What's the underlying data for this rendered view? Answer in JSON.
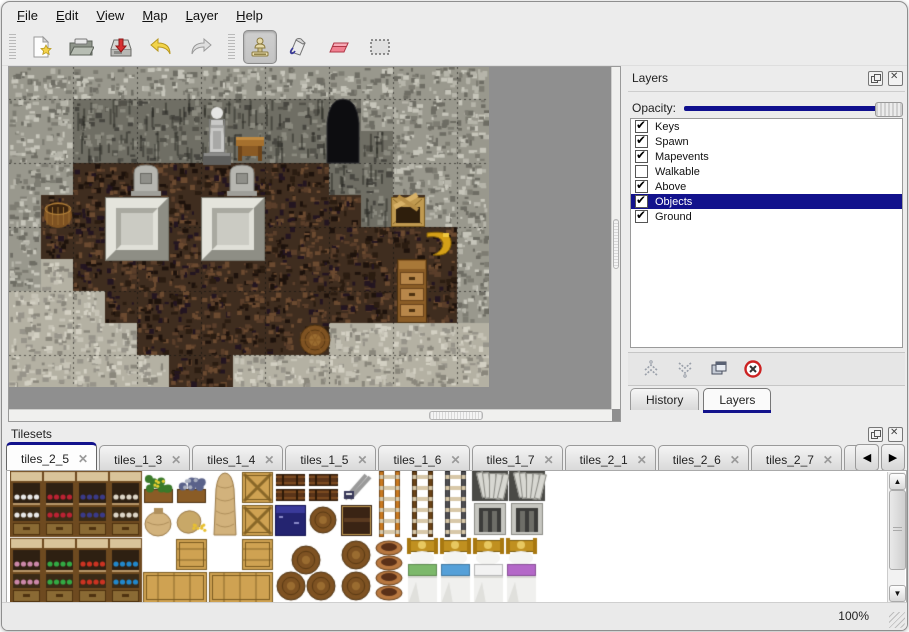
{
  "menu": {
    "items": [
      {
        "label": "File"
      },
      {
        "label": "Edit"
      },
      {
        "label": "View"
      },
      {
        "label": "Map"
      },
      {
        "label": "Layer"
      },
      {
        "label": "Help"
      }
    ]
  },
  "toolbar": {
    "tools": [
      {
        "name": "new",
        "icon": "new-file-icon",
        "selected": false
      },
      {
        "name": "open",
        "icon": "open-folder-icon",
        "selected": false
      },
      {
        "name": "save",
        "icon": "save-icon",
        "selected": false
      },
      {
        "name": "undo",
        "icon": "undo-arrow-icon",
        "selected": false
      },
      {
        "name": "redo",
        "icon": "redo-arrow-icon",
        "selected": false
      },
      {
        "name": "stamp",
        "icon": "stamp-tool-icon",
        "selected": true
      },
      {
        "name": "fill",
        "icon": "fill-tool-icon",
        "selected": false
      },
      {
        "name": "eraser",
        "icon": "eraser-tool-icon",
        "selected": false
      },
      {
        "name": "select",
        "icon": "select-rect-icon",
        "selected": false
      }
    ]
  },
  "layers_panel": {
    "title": "Layers",
    "opacity_label": "Opacity:",
    "opacity_fraction": 1.0,
    "layers": [
      {
        "name": "Keys",
        "checked": true,
        "selected": false
      },
      {
        "name": "Spawn",
        "checked": true,
        "selected": false
      },
      {
        "name": "Mapevents",
        "checked": true,
        "selected": false
      },
      {
        "name": "Walkable",
        "checked": false,
        "selected": false
      },
      {
        "name": "Above",
        "checked": true,
        "selected": false
      },
      {
        "name": "Objects",
        "checked": true,
        "selected": true
      },
      {
        "name": "Ground",
        "checked": true,
        "selected": false
      }
    ],
    "buttons": [
      {
        "name": "raise-layer"
      },
      {
        "name": "lower-layer"
      },
      {
        "name": "duplicate-layer"
      },
      {
        "name": "delete-layer"
      }
    ],
    "tabs": [
      {
        "label": "History",
        "active": false
      },
      {
        "label": "Layers",
        "active": true
      }
    ]
  },
  "tilesets_panel": {
    "title": "Tilesets",
    "tabs": [
      {
        "label": "tiles_2_5",
        "active": true
      },
      {
        "label": "tiles_1_3",
        "active": false
      },
      {
        "label": "tiles_1_4",
        "active": false
      },
      {
        "label": "tiles_1_5",
        "active": false
      },
      {
        "label": "tiles_1_6",
        "active": false
      },
      {
        "label": "tiles_1_7",
        "active": false
      },
      {
        "label": "tiles_2_1",
        "active": false
      },
      {
        "label": "tiles_2_6",
        "active": false
      },
      {
        "label": "tiles_2_7",
        "active": false
      },
      {
        "label": "tiles_",
        "active": false
      }
    ]
  },
  "statusbar": {
    "zoom": "100%"
  },
  "map": {
    "tile_size": 32,
    "cols": 15,
    "rows": 10,
    "legend": {
      "W": "rock wall",
      "D": "dark rock face",
      "F": "wood plank floor",
      "S": "stone floor"
    },
    "tiles": [
      "WWWWWWWWWWWWWWW",
      "WWDDDDDDDDDWWWW",
      "WWDDDDDDDDDDWWW",
      "WWFFFFFFFFDDWWW",
      "WFFFFFFFFFFDFWW",
      "WFFFFFFFFFFFFFW",
      "WSFFFFFFFFFFFFW",
      "SSSFFFFFFFFFFFW",
      "SSSSFFFFFFSSSSS",
      "SSSSSFFSSSSSSSS"
    ],
    "objects": [
      {
        "kind": "entrance",
        "x": 316,
        "y": 30
      },
      {
        "kind": "statue",
        "x": 192,
        "y": 34
      },
      {
        "kind": "table",
        "x": 226,
        "y": 66
      },
      {
        "kind": "tomb",
        "x": 122,
        "y": 96
      },
      {
        "kind": "tomb",
        "x": 218,
        "y": 96
      },
      {
        "kind": "slab",
        "x": 96,
        "y": 130
      },
      {
        "kind": "slab",
        "x": 192,
        "y": 130
      },
      {
        "kind": "basket",
        "x": 34,
        "y": 130
      },
      {
        "kind": "crate_broken",
        "x": 382,
        "y": 126
      },
      {
        "kind": "horn",
        "x": 414,
        "y": 160
      },
      {
        "kind": "cabinet",
        "x": 388,
        "y": 192
      },
      {
        "kind": "barrel",
        "x": 290,
        "y": 256
      }
    ]
  },
  "palette": {
    "items": [
      {
        "kind": "shelf",
        "x": 0,
        "y": 0,
        "accent": "#e8e8e8"
      },
      {
        "kind": "shelf",
        "x": 33,
        "y": 0,
        "accent": "#bb2233"
      },
      {
        "kind": "shelf",
        "x": 66,
        "y": 0,
        "accent": "#3a3a88"
      },
      {
        "kind": "shelf",
        "x": 99,
        "y": 0,
        "accent": "#ddd6c8"
      },
      {
        "kind": "plant",
        "x": 132,
        "y": 0
      },
      {
        "kind": "graycrate",
        "x": 165,
        "y": 0
      },
      {
        "kind": "sackbig",
        "x": 198,
        "y": 0
      },
      {
        "kind": "cratex",
        "x": 231,
        "y": 0
      },
      {
        "kind": "kegs",
        "x": 264,
        "y": 0
      },
      {
        "kind": "kegs",
        "x": 297,
        "y": 0
      },
      {
        "kind": "sign",
        "x": 330,
        "y": 0
      },
      {
        "kind": "sack",
        "x": 132,
        "y": 33
      },
      {
        "kind": "sackspill",
        "x": 165,
        "y": 33
      },
      {
        "kind": "cratex",
        "x": 231,
        "y": 33
      },
      {
        "kind": "bluecrate",
        "x": 264,
        "y": 33
      },
      {
        "kind": "kegface",
        "x": 297,
        "y": 33
      },
      {
        "kind": "darkcrate",
        "x": 330,
        "y": 33
      },
      {
        "kind": "ladder",
        "x": 363,
        "y": 0,
        "accent": "#c87820"
      },
      {
        "kind": "ladder",
        "x": 396,
        "y": 0,
        "accent": "#6a4318"
      },
      {
        "kind": "ladder",
        "x": 429,
        "y": 0,
        "accent": "#4e4e52"
      },
      {
        "kind": "arch",
        "x": 462,
        "y": 0
      },
      {
        "kind": "arch",
        "x": 499,
        "y": 0
      },
      {
        "kind": "shelf",
        "x": 0,
        "y": 67,
        "accent": "#cc88aa"
      },
      {
        "kind": "shelf",
        "x": 33,
        "y": 67,
        "accent": "#33aa44"
      },
      {
        "kind": "shelf",
        "x": 66,
        "y": 67,
        "accent": "#cc3322"
      },
      {
        "kind": "shelf",
        "x": 99,
        "y": 67,
        "accent": "#2288cc"
      },
      {
        "kind": "crate",
        "x": 165,
        "y": 67
      },
      {
        "kind": "crate",
        "x": 231,
        "y": 67
      },
      {
        "kind": "cratelong",
        "x": 132,
        "y": 100
      },
      {
        "kind": "cratelong",
        "x": 198,
        "y": 100
      },
      {
        "kind": "barrelpile",
        "x": 264,
        "y": 67
      },
      {
        "kind": "barrelstack",
        "x": 330,
        "y": 67
      },
      {
        "kind": "pots",
        "x": 363,
        "y": 67
      },
      {
        "kind": "bed",
        "x": 396,
        "y": 67,
        "accent": "#7cb86a"
      },
      {
        "kind": "bed",
        "x": 429,
        "y": 67,
        "accent": "#55a0d8"
      },
      {
        "kind": "bed",
        "x": 462,
        "y": 67,
        "accent": "#f2f2f2"
      },
      {
        "kind": "bed",
        "x": 495,
        "y": 67,
        "accent": "#b468c8"
      }
    ]
  },
  "colors": {
    "selection": "#12128c",
    "accent": "#12128c",
    "map_background": "#8f8f8f",
    "panel_background": "#ececec"
  }
}
